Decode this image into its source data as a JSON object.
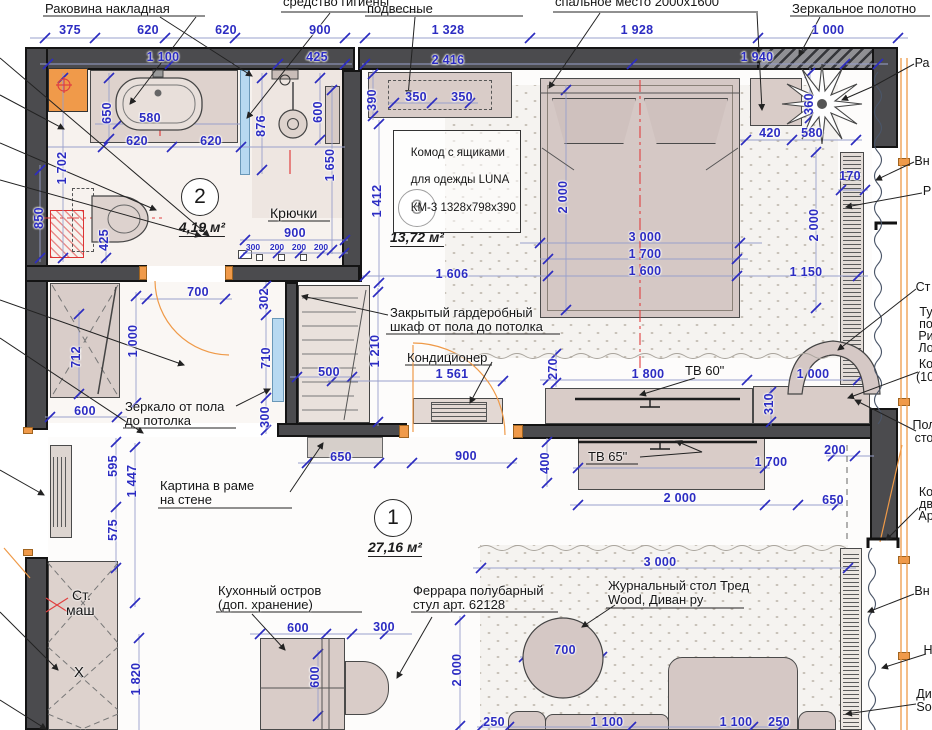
{
  "colors": {
    "dimension_blue": "#2c2cc2",
    "wall_gray": "#4b4b4e",
    "frame_orange": "#f09a4a",
    "accent_red": "#d93636",
    "tile_blue": "#b7d9f1"
  },
  "rooms": [
    {
      "num": "2",
      "area": "4,19 м²"
    },
    {
      "num": "3",
      "area": "13,72 м²"
    },
    {
      "num": "1",
      "area": "27,16 м²"
    }
  ],
  "annotations": {
    "sink_top": "Раковина накладная",
    "hygiene": "средство гигиены",
    "hanging": "подвесные",
    "sleeping": "спальное место 2000х1600",
    "mirror_cloth": "Зеркальное полотно",
    "dresser1": "Комод с ящиками",
    "dresser2": "для одежды LUNA",
    "dresser3": "КМ-3 1328х798х390",
    "hooks": "Крючки",
    "closet1": "Закрытый гардеробный",
    "closet2": "шкаф от пола до потолка",
    "ac": "Кондиционер",
    "mirror1": "Зеркало от пола",
    "mirror2": "до потолка",
    "tv60": "ТВ 60\"",
    "tv65": "ТВ 65\"",
    "painting1": "Картина в раме",
    "painting2": "на стене",
    "island1": "Кухонный остров",
    "island2": "(доп. хранение)",
    "stool1": "Феррара полубарный",
    "stool2": "стул арт. 62128",
    "table1": "Журнальный стол Тред",
    "table2": "Wood, Диван ру",
    "wash1": "Ст.",
    "wash2": "маш",
    "x_mark": "X"
  },
  "edge": [
    "Ра",
    "Вн",
    "Р",
    "Ст",
    "Ту",
    "по",
    "Ри",
    "Ло",
    "Ко",
    "(10",
    "Пол",
    "сто",
    "Ко",
    "дв",
    "Ар",
    "Вн",
    "Н",
    "Ди",
    "So"
  ],
  "dims": [
    "375",
    "620",
    "620",
    "900",
    "1 328",
    "1 928",
    "1 000",
    "1 100",
    "425",
    "2 416",
    "1 940",
    "580",
    "620",
    "620",
    "650",
    "1 702",
    "850",
    "425",
    "876",
    "600",
    "1 650",
    "900",
    "300",
    "200",
    "200",
    "200",
    "390",
    "350",
    "350",
    "1 412",
    "2 000",
    "3 000",
    "1 700",
    "1 600",
    "1 606",
    "1 150",
    "2 000",
    "420",
    "580",
    "360",
    "170",
    "270",
    "1 800",
    "1 000",
    "310",
    "700",
    "302",
    "1 000",
    "712",
    "600",
    "710",
    "300",
    "500",
    "1 210",
    "1 561",
    "650",
    "900",
    "400",
    "200",
    "1 700",
    "2 000",
    "650",
    "595",
    "1 447",
    "575",
    "1 820",
    "600",
    "300",
    "600",
    "2 000",
    "3 000",
    "700",
    "250",
    "1 100",
    "1 100",
    "250"
  ]
}
